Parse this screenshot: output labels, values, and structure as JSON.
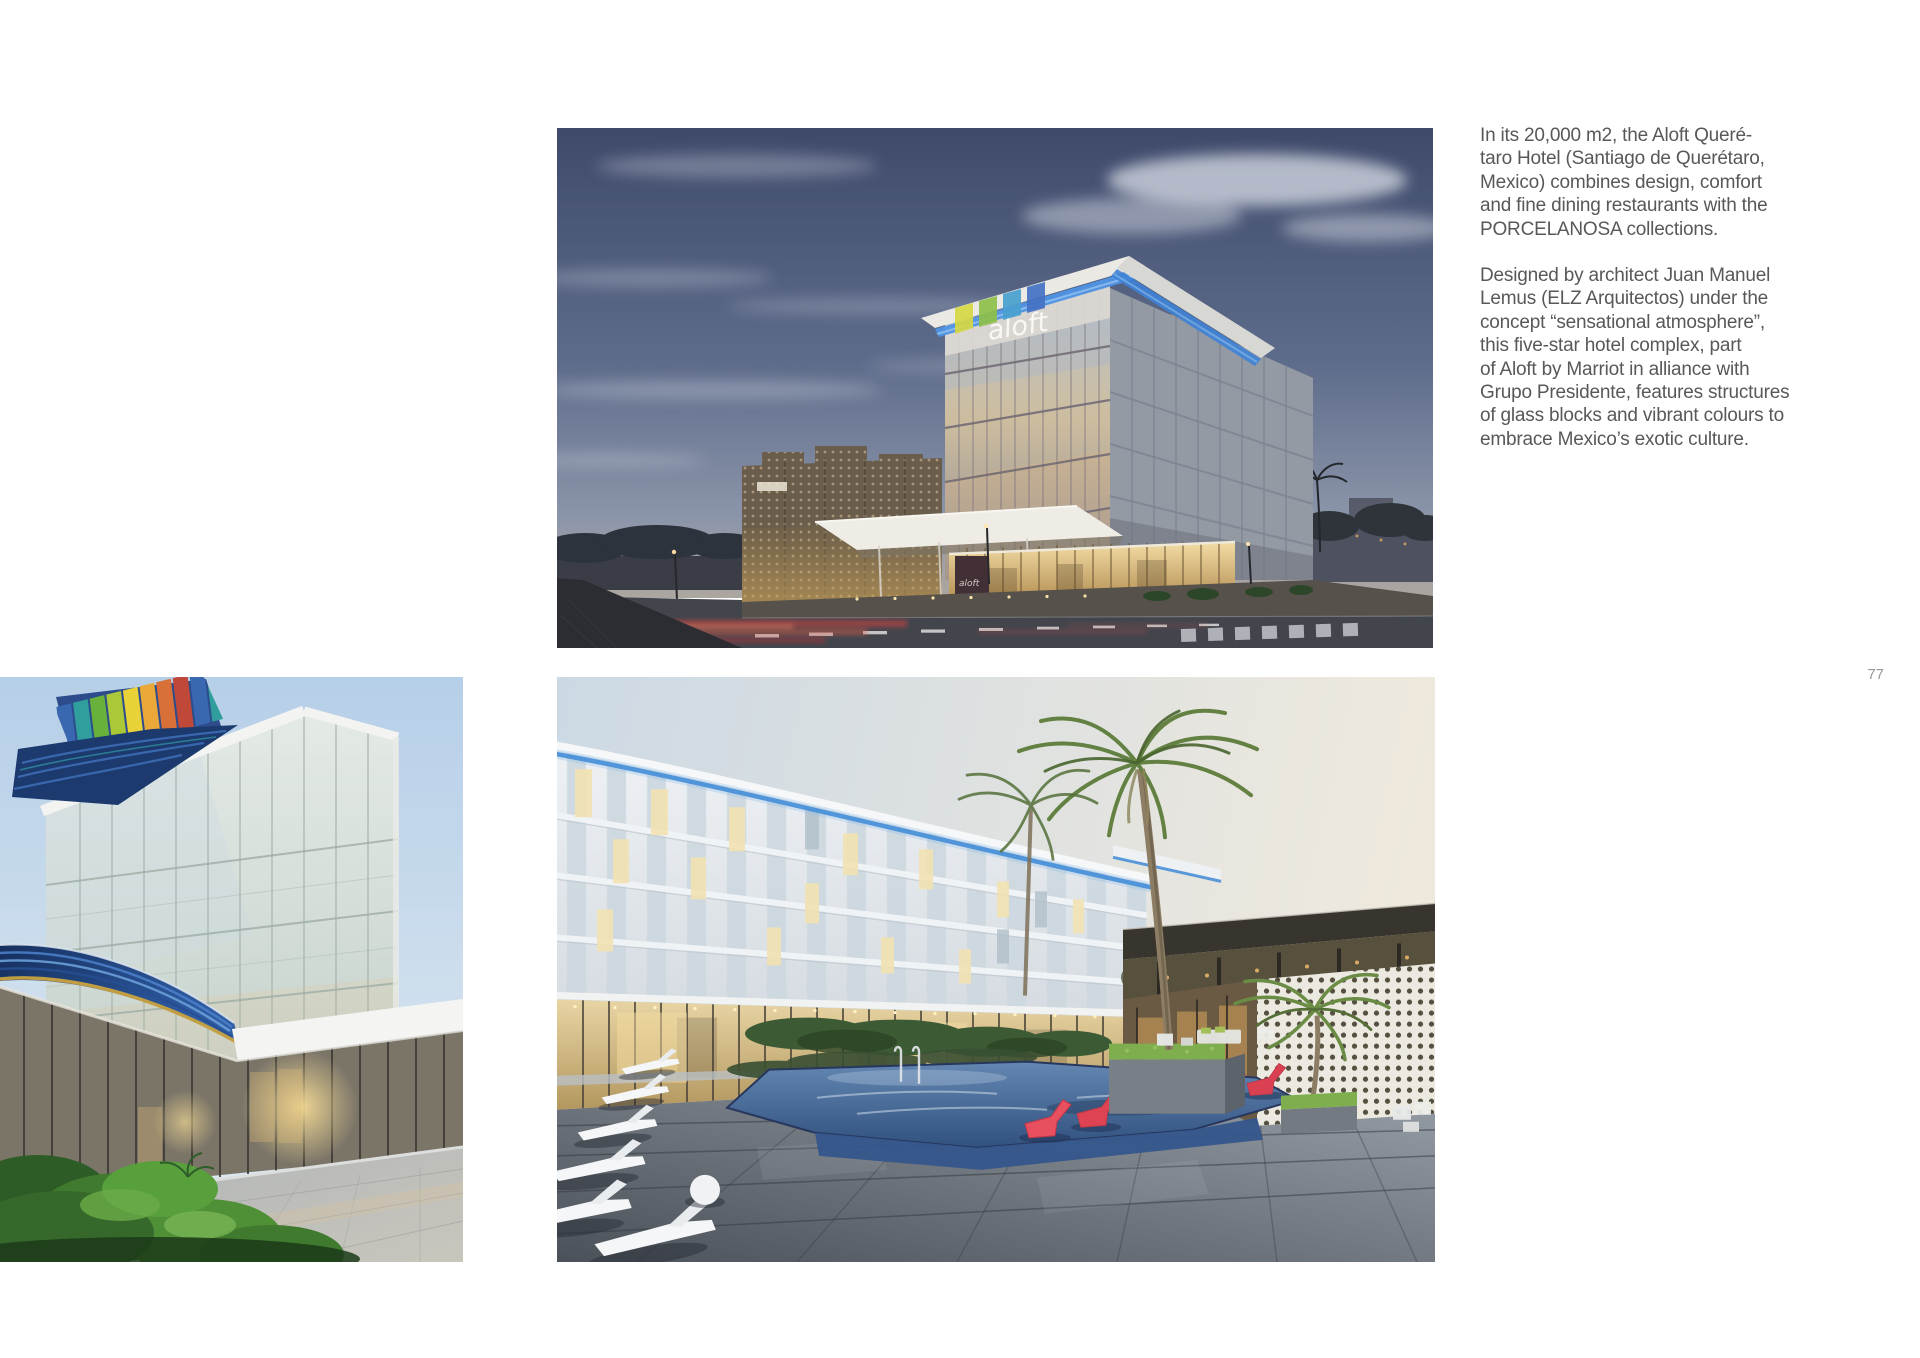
{
  "page": {
    "background_color": "#ffffff",
    "number": "77"
  },
  "article": {
    "text_color": "#57585a",
    "paragraph_1": "In its 20,000 m2, the Aloft Queré-\ntaro Hotel (Santiago de Querétaro,\nMexico) combines design, comfort\nand fine dining restaurants with the\nPORCELANOSA collections.",
    "paragraph_2": "Designed by architect Juan Manuel\nLemus (ELZ Arquitectos) under the\nconcept “sensational atmosphere”,\nthis five-star hotel complex, part\nof Aloft by Marriot in alliance with\nGrupo Presidente, features structures\nof glass blocks and vibrant colours to\nembrace Mexico’s exotic culture."
  },
  "photos": {
    "top": {
      "alt": "Aloft Querétaro hotel exterior at dusk: glass tower with aloft roof sign, blue LED roofline, perforated screen wing, entrance canopy and road with red light trails"
    },
    "bottom_left": {
      "alt": "Hotel entrance close-up: glass curtain wall, rainbow-striped roof band, sweeping blue striped canopy, lobby glass and green shrubs"
    },
    "bottom_center": {
      "alt": "Pool terrace at dusk: white hotel facade with blue LED roofline, palm trees, pool with red submerged loungers, white deck chairs on stone paving"
    }
  },
  "accent_colors": {
    "led_blue": "#4a90d8",
    "lounger_red": "#e8505f",
    "canopy_navy": "#1d3a70",
    "sign_white": "#fbfaf7",
    "text_gray": "#57585a",
    "page_number_gray": "#98989a"
  }
}
